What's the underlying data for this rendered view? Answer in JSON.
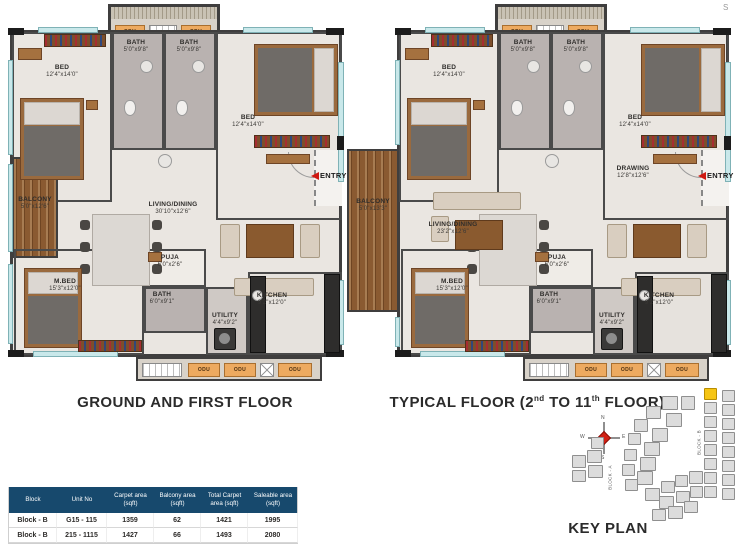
{
  "misc": {
    "stray_letter": "S"
  },
  "plans": [
    {
      "title": "GROUND AND FIRST FLOOR",
      "entry_label": "ENTRY",
      "odu_label": "ODU",
      "rooms": {
        "bed1": {
          "name": "BED",
          "dims": "12'4\"x14'0\""
        },
        "bath1": {
          "name": "BATH",
          "dims": "5'0\"x9'8\""
        },
        "bath2": {
          "name": "BATH",
          "dims": "5'0\"x9'8\""
        },
        "bed2": {
          "name": "BED",
          "dims": "12'4\"x14'0\""
        },
        "living": {
          "name": "LIVING/DINING",
          "dims": "30'10\"x12'6\""
        },
        "balcony": {
          "name": "BALCONY",
          "dims": "5'0\"x12'6\""
        },
        "puja": {
          "name": "PUJA",
          "dims": "6'0\"x2'6\""
        },
        "mbed": {
          "name": "M.BED",
          "dims": "15'3\"x12'0\""
        },
        "bath3": {
          "name": "BATH",
          "dims": "6'0\"x9'1\""
        },
        "utility": {
          "name": "UTILITY",
          "dims": "4'4\"x9'2\""
        },
        "kitchen": {
          "name": "KITCHEN",
          "dims": "9'2\"x12'0\""
        }
      }
    },
    {
      "title_parts": {
        "pre": "TYPICAL FLOOR (2",
        "sup1": "nd",
        "mid": " TO 11",
        "sup2": "th",
        "post": " FLOOR)"
      },
      "entry_label": "ENTRY",
      "odu_label": "ODU",
      "rooms": {
        "bed1": {
          "name": "BED",
          "dims": "12'4\"x14'0\""
        },
        "bath1": {
          "name": "BATH",
          "dims": "5'0\"x9'8\""
        },
        "bath2": {
          "name": "BATH",
          "dims": "5'0\"x9'8\""
        },
        "bed2": {
          "name": "BED",
          "dims": "12'4\"x14'0\""
        },
        "drawing": {
          "name": "DRAWING",
          "dims": "12'8\"x12'6\""
        },
        "living": {
          "name": "LIVING/DINING",
          "dims": "23'2\"x12'6\""
        },
        "balcony": {
          "name": "BALCONY",
          "dims": "5'0\"x13'3\""
        },
        "puja": {
          "name": "PUJA",
          "dims": "6'0\"x2'6\""
        },
        "mbed": {
          "name": "M.BED",
          "dims": "15'3\"x12'0\""
        },
        "bath3": {
          "name": "BATH",
          "dims": "6'0\"x9'1\""
        },
        "utility": {
          "name": "UTILITY",
          "dims": "4'4\"x9'2\""
        },
        "kitchen": {
          "name": "KITCHEN",
          "dims": "9'2\"x12'0\""
        }
      }
    }
  ],
  "table": {
    "headers": [
      "Block",
      "Unit No",
      "Carpet area\n(sqft)",
      "Balcony area\n(sqft)",
      "Total Carpet\narea (sqft)",
      "Saleable area\n(sqft)"
    ],
    "rows": [
      [
        "Block - B",
        "G15 - 115",
        "1359",
        "62",
        "1421",
        "1995"
      ],
      [
        "Block - B",
        "215 - 1115",
        "1427",
        "66",
        "1493",
        "2080"
      ]
    ]
  },
  "key_plan": {
    "title": "KEY PLAN",
    "block_a_label": "BLOCK - A",
    "block_b_label": "BLOCK - B",
    "compass": {
      "n": "N",
      "e": "E",
      "s": "S",
      "w": "W"
    }
  }
}
